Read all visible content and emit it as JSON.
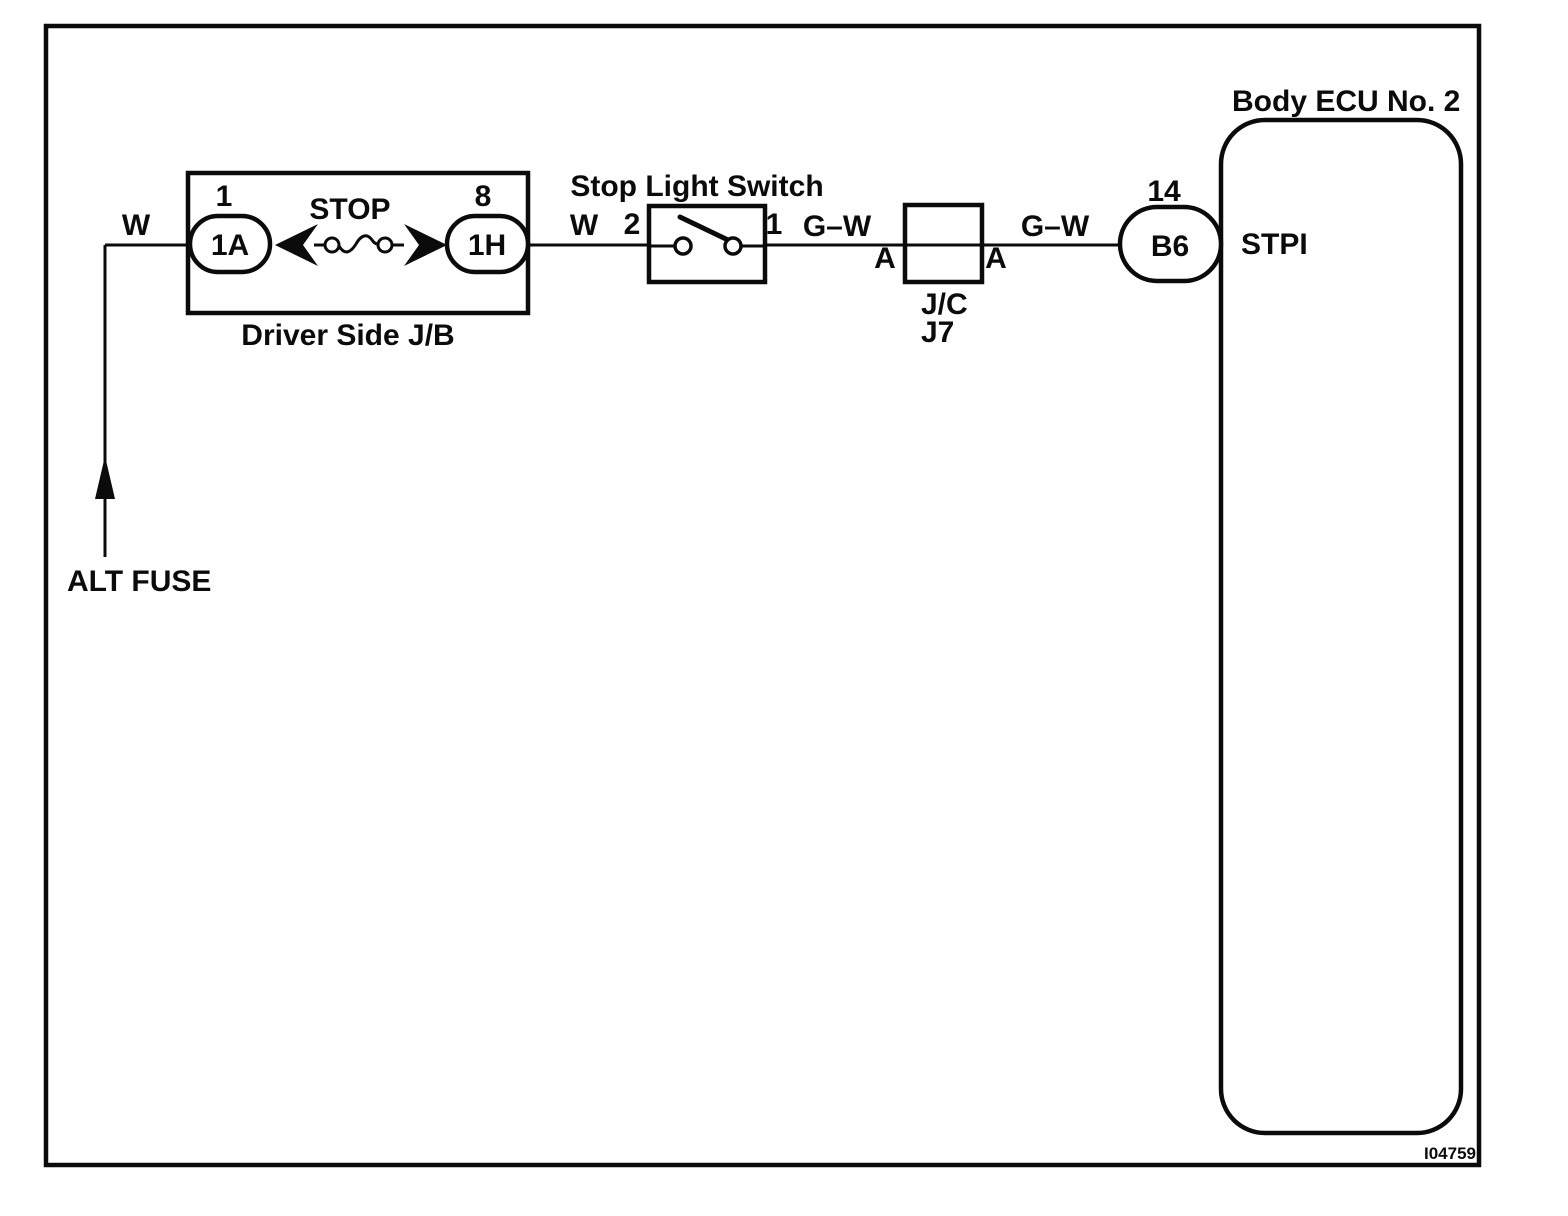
{
  "figure": {
    "number": "I04759"
  },
  "power_source": {
    "label": "ALT FUSE"
  },
  "wire_labels": {
    "w_feed": "W",
    "w_to_switch": "W",
    "gw_switch_to_jc": "G–W",
    "gw_jc_to_ecu": "G–W"
  },
  "driver_side_jb": {
    "label": "Driver Side J/B",
    "fuse_name": "STOP",
    "pin_in": "1",
    "cavity_in": "1A",
    "pin_out": "8",
    "cavity_out": "1H"
  },
  "stop_light_switch": {
    "label": "Stop Light Switch",
    "pin_left": "2",
    "pin_right": "1"
  },
  "junction_connector": {
    "type": "J/C",
    "id": "J7",
    "pin_left": "A",
    "pin_right": "A"
  },
  "body_ecu": {
    "label": "Body ECU No. 2",
    "pin": "14",
    "connector": "B6",
    "terminal": "STPI"
  }
}
